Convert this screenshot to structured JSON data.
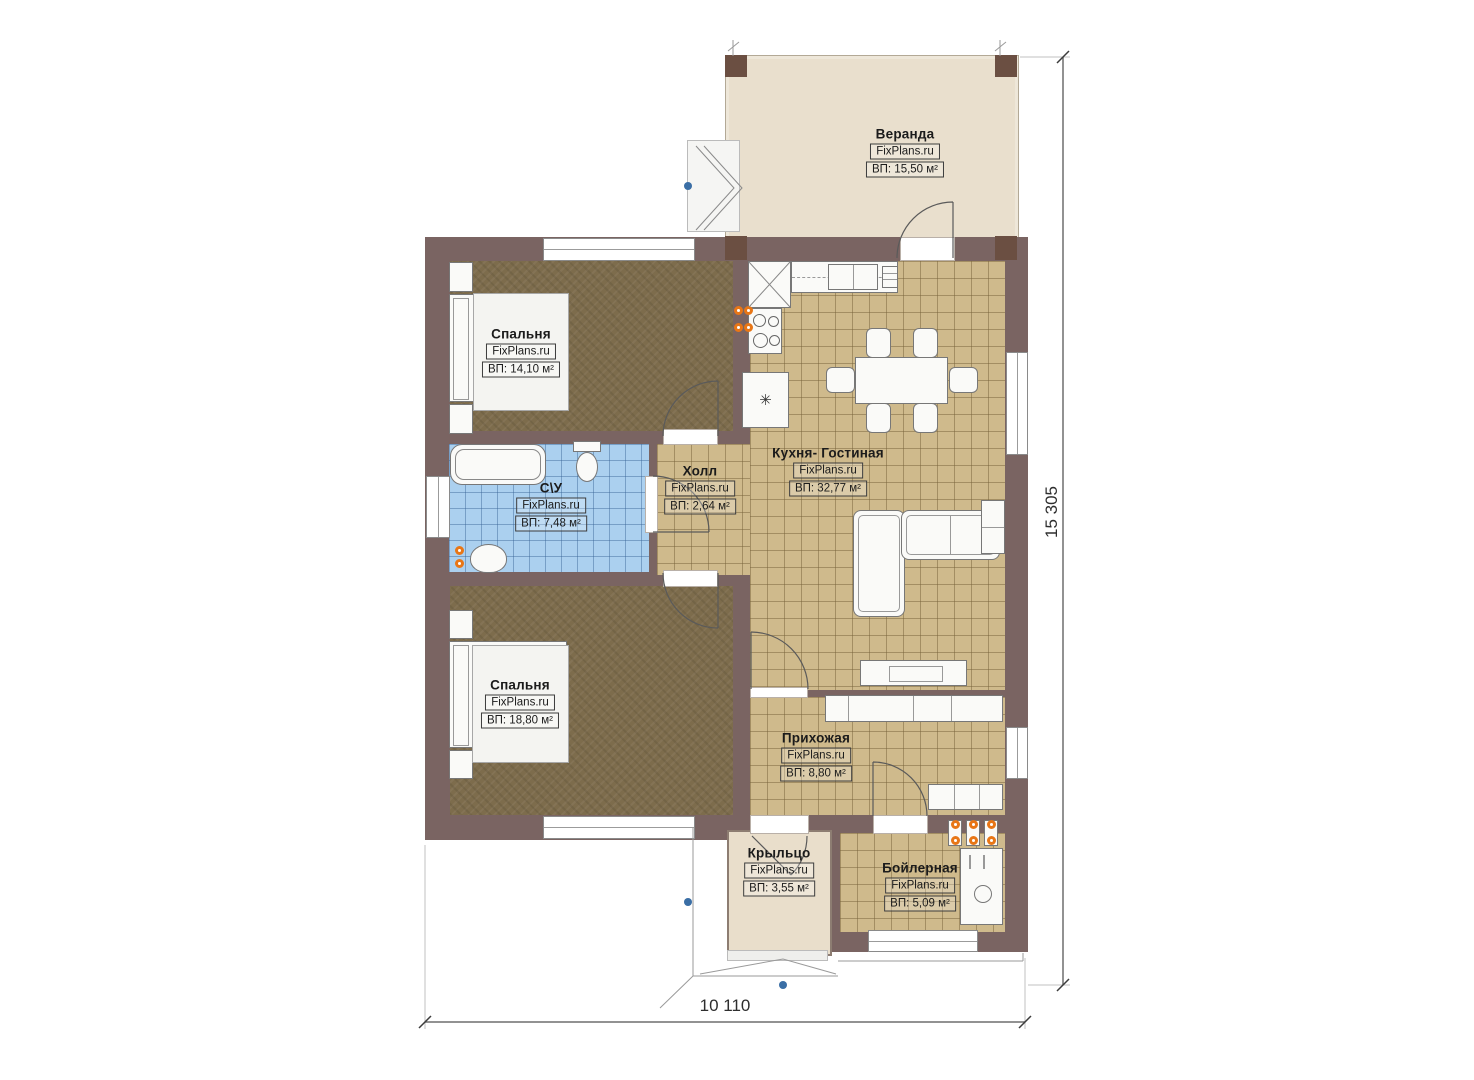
{
  "dimensions": {
    "width": "10 110",
    "height": "15 305"
  },
  "watermark": "FixPlans.ru",
  "rooms": [
    {
      "id": "veranda",
      "name": "Веранда",
      "watermark": "FixPlans.ru",
      "area": "ВП: 15,50 м²"
    },
    {
      "id": "bedroom1",
      "name": "Спальня",
      "watermark": "FixPlans.ru",
      "area": "ВП: 14,10 м²"
    },
    {
      "id": "bathroom",
      "name": "С\\У",
      "watermark": "FixPlans.ru",
      "area": "ВП: 7,48 м²"
    },
    {
      "id": "hall",
      "name": "Холл",
      "watermark": "FixPlans.ru",
      "area": "ВП: 2,64 м²"
    },
    {
      "id": "kitchen",
      "name": "Кухня- Гостиная",
      "watermark": "FixPlans.ru",
      "area": "ВП: 32,77 м²"
    },
    {
      "id": "bedroom2",
      "name": "Спальня",
      "watermark": "FixPlans.ru",
      "area": "ВП: 18,80 м²"
    },
    {
      "id": "hallway",
      "name": "Прихожая",
      "watermark": "FixPlans.ru",
      "area": "ВП: 8,80 м²"
    },
    {
      "id": "porch",
      "name": "Крыльцо",
      "watermark": "FixPlans.ru",
      "area": "ВП: 3,55 м²"
    },
    {
      "id": "boiler",
      "name": "Бойлерная",
      "watermark": "FixPlans.ru",
      "area": "ВП: 5,09 м²"
    }
  ],
  "symbols": {
    "boiler_unit": "✳"
  },
  "colors": {
    "wall": "#7a6462",
    "tile_floor": "#cfba8c",
    "bath_tile": "#abd0ef",
    "wood_floor": "#7d6c4c",
    "veranda_floor": "#e9dfcd",
    "accent_orange": "#e87616",
    "marker_blue": "#3a6ea5"
  }
}
